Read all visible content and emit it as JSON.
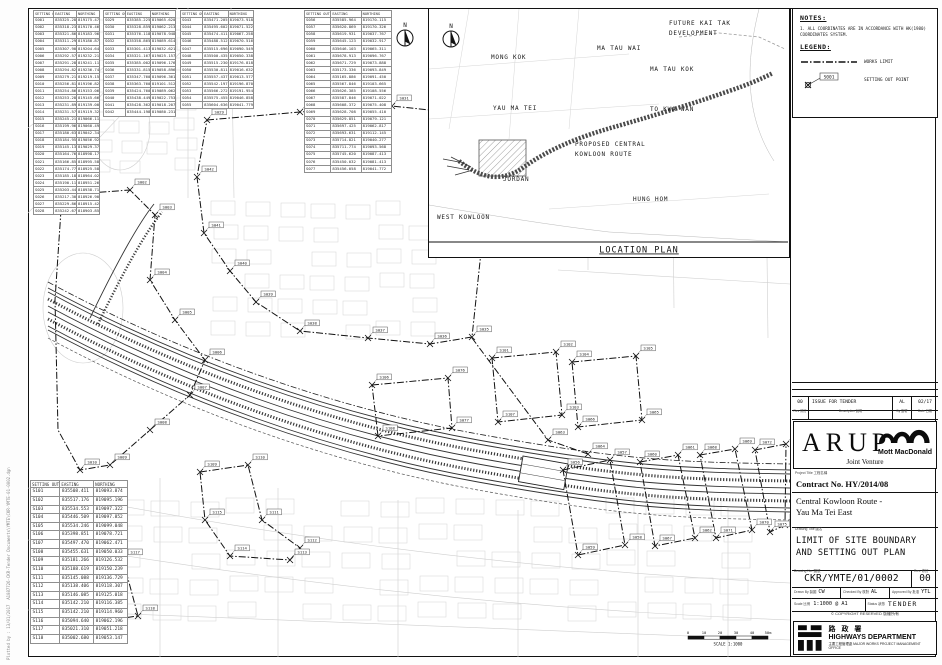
{
  "notes": {
    "title": "NOTES:",
    "n1": "1. ALL COORDINATES ARE IN ACCORDANCE WITH HK(1980)\n    COORDINATES SYSTEM."
  },
  "legend": {
    "title": "LEGEND:",
    "works_limit": "WORKS LIMIT",
    "setting_out_point": "SETTING OUT POINT",
    "sample_id": "S001"
  },
  "location_plan": {
    "title": "LOCATION PLAN",
    "labels": [
      {
        "t": "MONG KOK",
        "x": 62,
        "y": 50
      },
      {
        "t": "MA TAU WAI",
        "x": 168,
        "y": 41
      },
      {
        "t": "FUTURE KAI TAK",
        "x": 240,
        "y": 16
      },
      {
        "t": "DEVELOPMENT",
        "x": 240,
        "y": 26
      },
      {
        "t": "MA TAU KOK",
        "x": 221,
        "y": 62
      },
      {
        "t": "YAU MA TEI",
        "x": 64,
        "y": 101
      },
      {
        "t": "TO KWA WAN",
        "x": 221,
        "y": 102
      },
      {
        "t": "PROPOSED CENTRAL",
        "x": 146,
        "y": 137
      },
      {
        "t": "KOWLOON ROUTE",
        "x": 146,
        "y": 147
      },
      {
        "t": "JORDAN",
        "x": 74,
        "y": 172
      },
      {
        "t": "HUNG HOM",
        "x": 204,
        "y": 192
      },
      {
        "t": "WEST KOWLOON",
        "x": 8,
        "y": 210
      }
    ]
  },
  "scale_bar": {
    "ticks": [
      "0",
      "10",
      "20",
      "30",
      "40",
      "50m"
    ],
    "caption": "SCALE 1:1000"
  },
  "stamp": {
    "line1": "Plotted by : 13/01/2017",
    "line2": "A1087726-CKR-Tender Documents\\YMTE\\CKR-YMTE-01-0002.dgn"
  },
  "titleblock": {
    "rev_row": {
      "rev": "00",
      "desc": "ISSUE FOR TENDER",
      "by": "AL",
      "date": "02/17"
    },
    "rev_hdr": {
      "rev": "Rev 修訂",
      "desc": "Description 說明",
      "by": "By 簽署",
      "date": "Date 日期"
    },
    "arup": "ARUP",
    "mott": "Mott MacDonald",
    "jv": "Joint Venture",
    "project_label": "Project Title 工程名稱",
    "contract": "Contract No. HY/2014/08",
    "project_line1": "Central Kowloon Route -",
    "project_line2": "Yau Ma Tei East",
    "drawing_title_label": "Drawing Title 圖名",
    "drawing_title": "LIMIT OF SITE BOUNDARY\nAND SETTING OUT PLAN",
    "dno_label": "Drawing No. 圖號",
    "dno": "CKR/YMTE/01/0002",
    "rev_label": "Rev. 修訂",
    "rev": "00",
    "drawn_label": "Drawn By 製圖",
    "drawn": "CW",
    "checked_label": "Checked By 核對",
    "checked": "AL",
    "approved_label": "Approved By 批准",
    "approved": "YTL",
    "scale_label": "Scale 比例",
    "scale": "1:1000 @ A1",
    "status_label": "Status 狀態",
    "status": "TENDER",
    "copyright": "© COPYRIGHT RESERVED 版權所有",
    "hyd_cn": "路 政 署",
    "hyd_en": "HIGHWAYS DEPARTMENT",
    "hyd_sub": "主要工程管理處  MAJOR WORKS PROJECT MANAGEMENT OFFICE"
  },
  "tables": {
    "headers": {
      "point": "SETTING OUT POINT",
      "easting": "EASTING",
      "northing": "NORTHING"
    },
    "t1": {
      "rows": [
        {
          "p": "S001",
          "e": "835325.281",
          "n": "819175.476"
        },
        {
          "p": "S002",
          "e": "835318.237",
          "n": "819170.467"
        },
        {
          "p": "S003",
          "e": "835321.864",
          "n": "819183.968"
        },
        {
          "p": "S004",
          "e": "835311.293",
          "n": "819180.872"
        },
        {
          "p": "S005",
          "e": "835307.905",
          "n": "819204.641"
        },
        {
          "p": "S006",
          "e": "835292.574",
          "n": "819232.216"
        },
        {
          "p": "S007",
          "e": "835291.288",
          "n": "819241.112"
        },
        {
          "p": "S008",
          "e": "835294.827",
          "n": "819236.749"
        },
        {
          "p": "S009",
          "e": "835279.219",
          "n": "819219.158"
        },
        {
          "p": "S010",
          "e": "835256.814",
          "n": "819196.821"
        },
        {
          "p": "S011",
          "e": "835254.868",
          "n": "819153.064"
        },
        {
          "p": "S012",
          "e": "835253.289",
          "n": "819145.669"
        },
        {
          "p": "S013",
          "e": "835231.898",
          "n": "819139.008"
        },
        {
          "p": "S014",
          "e": "835231.577",
          "n": "819119.320"
        },
        {
          "p": "S015",
          "e": "835245.218",
          "n": "819066.112"
        },
        {
          "p": "S016",
          "e": "835199.961",
          "n": "819060.496"
        },
        {
          "p": "S017",
          "e": "835180.633",
          "n": "819042.345"
        },
        {
          "p": "S018",
          "e": "835184.952",
          "n": "819056.921"
        },
        {
          "p": "S019",
          "e": "835145.134",
          "n": "819029.378"
        },
        {
          "p": "S020",
          "e": "835164.767",
          "n": "818998.179"
        },
        {
          "p": "S021",
          "e": "835166.858",
          "n": "818995.588"
        },
        {
          "p": "S022",
          "e": "835174.778",
          "n": "818925.588"
        },
        {
          "p": "S023",
          "e": "835185.184",
          "n": "818964.029"
        },
        {
          "p": "S024",
          "e": "835190.112",
          "n": "818951.260"
        },
        {
          "p": "S025",
          "e": "835203.447",
          "n": "818938.714"
        },
        {
          "p": "S026",
          "e": "835217.305",
          "n": "818926.903"
        },
        {
          "p": "S027",
          "e": "835229.860",
          "n": "818915.427"
        },
        {
          "p": "S028",
          "e": "835242.671",
          "n": "818903.851"
        }
      ]
    },
    "t2": {
      "rows": [
        {
          "p": "S029",
          "e": "835385.225",
          "n": "819065.620"
        },
        {
          "p": "S030",
          "e": "835328.859",
          "n": "819062.213"
        },
        {
          "p": "S031",
          "e": "835376.118",
          "n": "819078.948"
        },
        {
          "p": "S032",
          "e": "835358.865",
          "n": "819089.614"
        },
        {
          "p": "S033",
          "e": "835301.413",
          "n": "819032.621"
        },
        {
          "p": "S034",
          "e": "835321.167",
          "n": "819025.157"
        },
        {
          "p": "S035",
          "e": "835385.002",
          "n": "819096.176"
        },
        {
          "p": "S036",
          "e": "835331.815",
          "n": "819058.896"
        },
        {
          "p": "S037",
          "e": "835347.760",
          "n": "819096.361"
        },
        {
          "p": "S038",
          "e": "835363.760",
          "n": "819101.512"
        },
        {
          "p": "S039",
          "e": "835424.760",
          "n": "819089.062"
        },
        {
          "p": "S040",
          "e": "835438.449",
          "n": "819022.753"
        },
        {
          "p": "S041",
          "e": "835428.362",
          "n": "819018.207"
        },
        {
          "p": "S042",
          "e": "835444.198",
          "n": "819080.231"
        }
      ]
    },
    "t3": {
      "rows": [
        {
          "p": "S043",
          "e": "835471.205",
          "n": "819073.918"
        },
        {
          "p": "S044",
          "e": "835495.602",
          "n": "819071.522"
        },
        {
          "p": "S045",
          "e": "835474.411",
          "n": "819067.258"
        },
        {
          "p": "S046",
          "e": "835488.512",
          "n": "819070.516"
        },
        {
          "p": "S047",
          "e": "835515.696",
          "n": "819090.549"
        },
        {
          "p": "S048",
          "e": "835500.435",
          "n": "819050.338"
        },
        {
          "p": "S049",
          "e": "835515.230",
          "n": "819176.818"
        },
        {
          "p": "S050",
          "e": "835530.811",
          "n": "819016.632"
        },
        {
          "p": "S051",
          "e": "835557.437",
          "n": "819013.577"
        },
        {
          "p": "S052",
          "e": "835542.197",
          "n": "819196.870"
        },
        {
          "p": "S053",
          "e": "835566.272",
          "n": "819191.954"
        },
        {
          "p": "S054",
          "e": "835575.455",
          "n": "819046.858"
        },
        {
          "p": "S055",
          "e": "835604.636",
          "n": "819041.779"
        }
      ]
    },
    "t4": {
      "rows": [
        {
          "p": "S056",
          "e": "835585.964",
          "n": "819170.115"
        },
        {
          "p": "S057",
          "e": "835620.869",
          "n": "819170.326"
        },
        {
          "p": "S058",
          "e": "835619.931",
          "n": "819037.767"
        },
        {
          "p": "S059",
          "e": "835645.123",
          "n": "819032.917"
        },
        {
          "p": "S060",
          "e": "835646.103",
          "n": "819065.311"
        },
        {
          "p": "S061",
          "e": "835678.913",
          "n": "819096.767"
        },
        {
          "p": "S062",
          "e": "835671.729",
          "n": "819073.888"
        },
        {
          "p": "S063",
          "e": "835173.336",
          "n": "819093.849"
        },
        {
          "p": "S064",
          "e": "835165.886",
          "n": "819091.450"
        },
        {
          "p": "S065",
          "e": "835567.846",
          "n": "819103.665"
        },
        {
          "p": "S066",
          "e": "835626.385",
          "n": "819108.556"
        },
        {
          "p": "S067",
          "e": "835587.846",
          "n": "819071.022"
        },
        {
          "p": "S068",
          "e": "835608.372",
          "n": "819075.408"
        },
        {
          "p": "S069",
          "e": "835628.708",
          "n": "819055.410"
        },
        {
          "p": "S070",
          "e": "835629.851",
          "n": "819079.121"
        },
        {
          "p": "S071",
          "e": "835697.425",
          "n": "819062.817"
        },
        {
          "p": "S072",
          "e": "835693.631",
          "n": "819112.145"
        },
        {
          "p": "S073",
          "e": "835714.821",
          "n": "819040.277"
        },
        {
          "p": "S074",
          "e": "835711.774",
          "n": "819093.568"
        },
        {
          "p": "S075",
          "e": "835745.620",
          "n": "819087.413"
        },
        {
          "p": "S076",
          "e": "835450.032",
          "n": "819081.413"
        },
        {
          "p": "S077",
          "e": "835456.058",
          "n": "819041.772"
        }
      ]
    },
    "t5": {
      "rows": [
        {
          "p": "S101",
          "e": "835508.411",
          "n": "819093.874"
        },
        {
          "p": "S102",
          "e": "835517.176",
          "n": "819095.196"
        },
        {
          "p": "S103",
          "e": "835534.553",
          "n": "819097.322"
        },
        {
          "p": "S104",
          "e": "835446.509",
          "n": "819097.852"
        },
        {
          "p": "S105",
          "e": "835534.246",
          "n": "819099.048"
        },
        {
          "p": "S106",
          "e": "835398.851",
          "n": "819078.721"
        },
        {
          "p": "S107",
          "e": "835497.470",
          "n": "819062.471"
        },
        {
          "p": "S108",
          "e": "835455.631",
          "n": "819050.033"
        },
        {
          "p": "S109",
          "e": "835181.266",
          "n": "819126.532"
        },
        {
          "p": "S110",
          "e": "835188.619",
          "n": "819150.239"
        },
        {
          "p": "S111",
          "e": "835145.088",
          "n": "819136.729"
        },
        {
          "p": "S112",
          "e": "835138.406",
          "n": "819118.307"
        },
        {
          "p": "S113",
          "e": "835146.085",
          "n": "819125.018"
        },
        {
          "p": "S114",
          "e": "835142.210",
          "n": "819116.385"
        },
        {
          "p": "S115",
          "e": "835142.210",
          "n": "819114.960"
        },
        {
          "p": "S116",
          "e": "835094.640",
          "n": "819062.196"
        },
        {
          "p": "S117",
          "e": "835021.310",
          "n": "819051.218"
        },
        {
          "p": "S118",
          "e": "835002.680",
          "n": "819053.147"
        }
      ]
    }
  },
  "plan_points": [
    {
      "id": "S029",
      "x": 179,
      "y": 112
    },
    {
      "id": "S030",
      "x": 272,
      "y": 104
    },
    {
      "id": "S031",
      "x": 364,
      "y": 98
    },
    {
      "id": "S032",
      "x": 439,
      "y": 106
    },
    {
      "id": "S033",
      "x": 456,
      "y": 154
    },
    {
      "id": "S034",
      "x": 453,
      "y": 244
    },
    {
      "id": "S035",
      "x": 444,
      "y": 329
    },
    {
      "id": "S036",
      "x": 402,
      "y": 336
    },
    {
      "id": "S037",
      "x": 340,
      "y": 330
    },
    {
      "id": "S038",
      "x": 272,
      "y": 323
    },
    {
      "id": "S039",
      "x": 228,
      "y": 294
    },
    {
      "id": "S040",
      "x": 202,
      "y": 263
    },
    {
      "id": "S041",
      "x": 176,
      "y": 225
    },
    {
      "id": "S042",
      "x": 169,
      "y": 169
    },
    {
      "id": "S001",
      "x": 34,
      "y": 187
    },
    {
      "id": "S002",
      "x": 102,
      "y": 182
    },
    {
      "id": "S003",
      "x": 127,
      "y": 207
    },
    {
      "id": "S004",
      "x": 122,
      "y": 272
    },
    {
      "id": "S005",
      "x": 147,
      "y": 312
    },
    {
      "id": "S006",
      "x": 177,
      "y": 352
    },
    {
      "id": "S007",
      "x": 162,
      "y": 387
    },
    {
      "id": "S008",
      "x": 122,
      "y": 422
    },
    {
      "id": "S009",
      "x": 82,
      "y": 457
    },
    {
      "id": "S010",
      "x": 52,
      "y": 462
    },
    {
      "id": "S106",
      "x": 344,
      "y": 377
    },
    {
      "id": "S076",
      "x": 420,
      "y": 370
    },
    {
      "id": "S077",
      "x": 424,
      "y": 420
    },
    {
      "id": "S108",
      "x": 350,
      "y": 428
    },
    {
      "id": "S101",
      "x": 464,
      "y": 350
    },
    {
      "id": "S102",
      "x": 528,
      "y": 344
    },
    {
      "id": "S103",
      "x": 534,
      "y": 407
    },
    {
      "id": "S107",
      "x": 470,
      "y": 414
    },
    {
      "id": "S104",
      "x": 544,
      "y": 354
    },
    {
      "id": "S105",
      "x": 608,
      "y": 348
    },
    {
      "id": "S065",
      "x": 614,
      "y": 412
    },
    {
      "id": "S066",
      "x": 550,
      "y": 419
    },
    {
      "id": "S056",
      "x": 535,
      "y": 462
    },
    {
      "id": "S057",
      "x": 582,
      "y": 452
    },
    {
      "id": "S058",
      "x": 597,
      "y": 537
    },
    {
      "id": "S059",
      "x": 550,
      "y": 547
    },
    {
      "id": "S060",
      "x": 612,
      "y": 454
    },
    {
      "id": "S061",
      "x": 650,
      "y": 447
    },
    {
      "id": "S062",
      "x": 667,
      "y": 530
    },
    {
      "id": "S067",
      "x": 627,
      "y": 538
    },
    {
      "id": "S068",
      "x": 672,
      "y": 447
    },
    {
      "id": "S069",
      "x": 707,
      "y": 441
    },
    {
      "id": "S070",
      "x": 724,
      "y": 522
    },
    {
      "id": "S071",
      "x": 688,
      "y": 530
    },
    {
      "id": "S072",
      "x": 727,
      "y": 442
    },
    {
      "id": "S073",
      "x": 758,
      "y": 436
    },
    {
      "id": "S074",
      "x": 757,
      "y": 517
    },
    {
      "id": "S075",
      "x": 742,
      "y": 524
    },
    {
      "id": "S109",
      "x": 172,
      "y": 464
    },
    {
      "id": "S110",
      "x": 220,
      "y": 457
    },
    {
      "id": "S111",
      "x": 234,
      "y": 512
    },
    {
      "id": "S112",
      "x": 272,
      "y": 540
    },
    {
      "id": "S113",
      "x": 262,
      "y": 552
    },
    {
      "id": "S114",
      "x": 202,
      "y": 548
    },
    {
      "id": "S115",
      "x": 177,
      "y": 512
    },
    {
      "id": "S116",
      "x": 20,
      "y": 560
    },
    {
      "id": "S117",
      "x": 95,
      "y": 552
    },
    {
      "id": "S118",
      "x": 110,
      "y": 608
    },
    {
      "id": "S063",
      "x": 520,
      "y": 432
    },
    {
      "id": "S064",
      "x": 560,
      "y": 446
    }
  ]
}
